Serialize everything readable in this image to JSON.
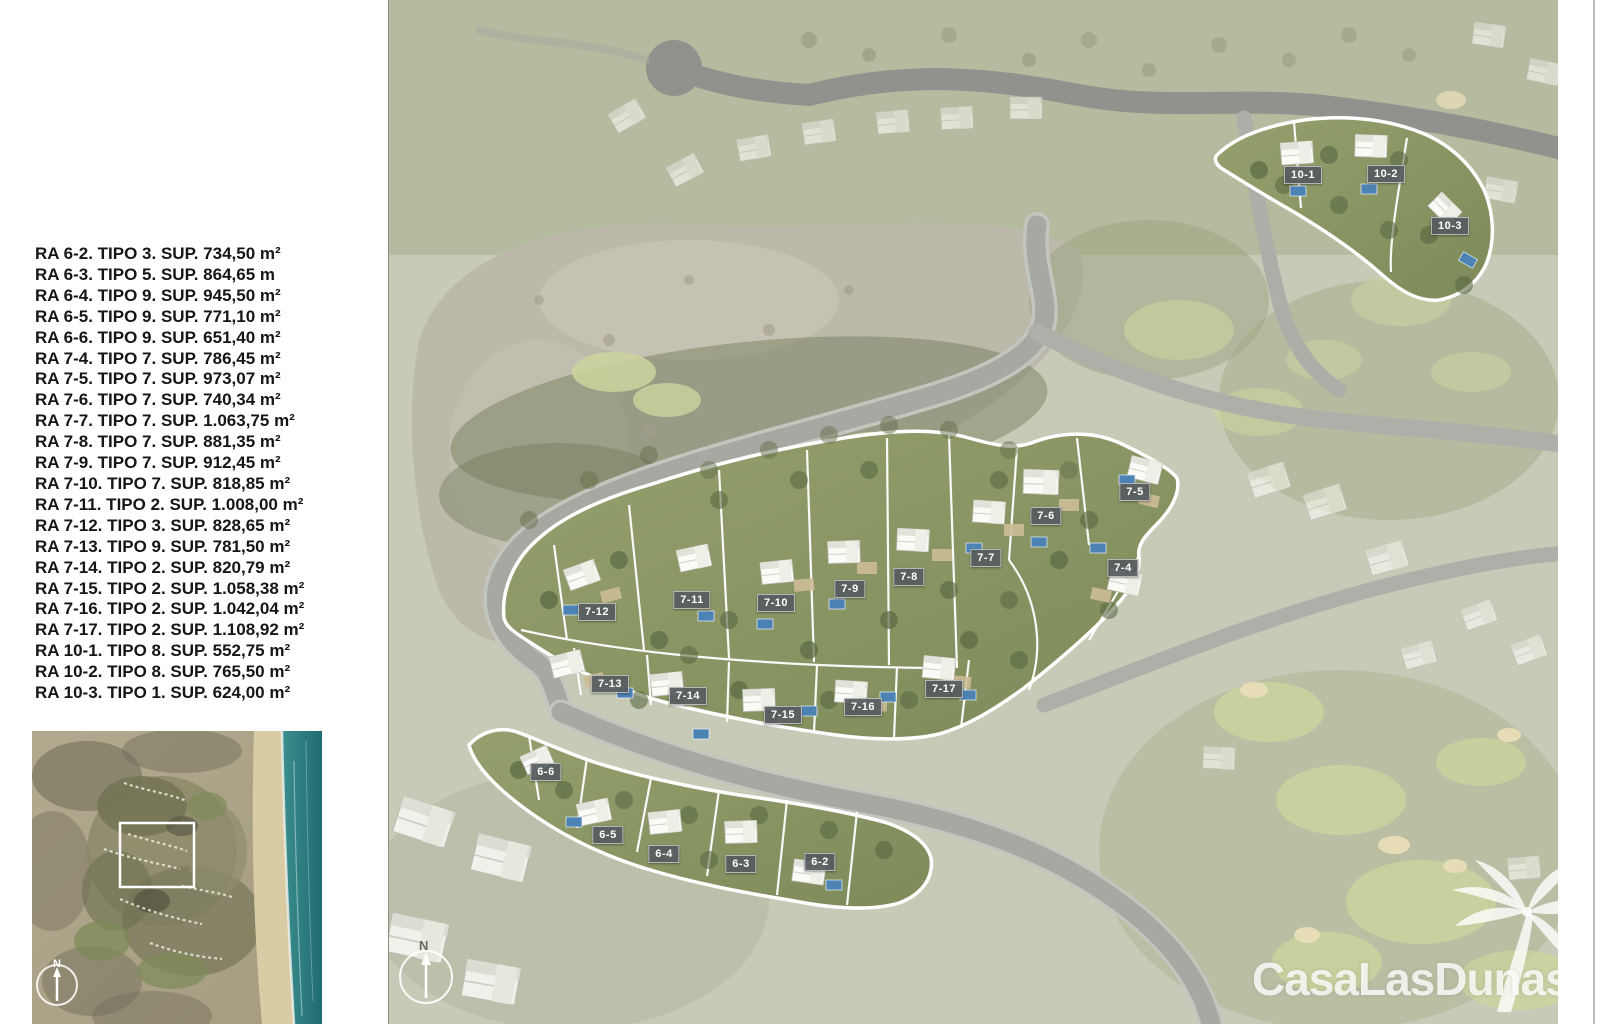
{
  "legend": {
    "items": [
      "RA 6-2. TIPO 3. SUP. 734,50 m²",
      "RA 6-3. TIPO 5. SUP. 864,65 m",
      "RA 6-4. TIPO 9. SUP. 945,50 m²",
      "RA 6-5. TIPO 9. SUP. 771,10 m²",
      "RA 6-6. TIPO 9. SUP. 651,40 m²",
      "RA 7-4. TIPO 7. SUP. 786,45 m²",
      "RA 7-5. TIPO 7. SUP. 973,07 m²",
      "RA 7-6. TIPO 7. SUP. 740,34 m²",
      "RA 7-7. TIPO 7. SUP. 1.063,75 m²",
      "RA 7-8. TIPO 7. SUP. 881,35 m²",
      "RA 7-9. TIPO 7. SUP. 912,45 m²",
      "RA 7-10. TIPO 7. SUP. 818,85 m²",
      "RA 7-11. TIPO 2. SUP. 1.008,00 m²",
      "RA 7-12. TIPO 3. SUP. 828,65 m²",
      "RA 7-13. TIPO 9. SUP. 781,50 m²",
      "RA 7-14. TIPO 2. SUP. 820,79 m²",
      "RA 7-15. TIPO 2. SUP. 1.058,38 m²",
      "RA 7-16. TIPO 2. SUP. 1.042,04 m²",
      "RA 7-17. TIPO 2. SUP. 1.108,92 m²",
      "RA 10-1. TIPO 8. SUP. 552,75 m²",
      "RA 10-2. TIPO 8. SUP. 765,50 m²",
      "RA 10-3. TIPO 1. SUP. 624,00 m²"
    ]
  },
  "inset": {
    "north_label": "N"
  },
  "map": {
    "north_label": "N",
    "logo_text": "CasaLasDunas",
    "plot_labels": [
      "10-1",
      "10-2",
      "10-3",
      "7-5",
      "7-6",
      "7-4",
      "7-7",
      "7-8",
      "7-9",
      "7-10",
      "7-11",
      "7-12",
      "7-13",
      "7-14",
      "7-15",
      "7-16",
      "7-17",
      "6-6",
      "6-5",
      "6-4",
      "6-3",
      "6-2"
    ]
  },
  "colors": {
    "plot_label_bg": "#565b5f",
    "plot_outline": "#ffffff",
    "cluster_green": "#8c9768",
    "road_gray": "#a6a8a2",
    "ocean_teal": "#2f7f84"
  }
}
